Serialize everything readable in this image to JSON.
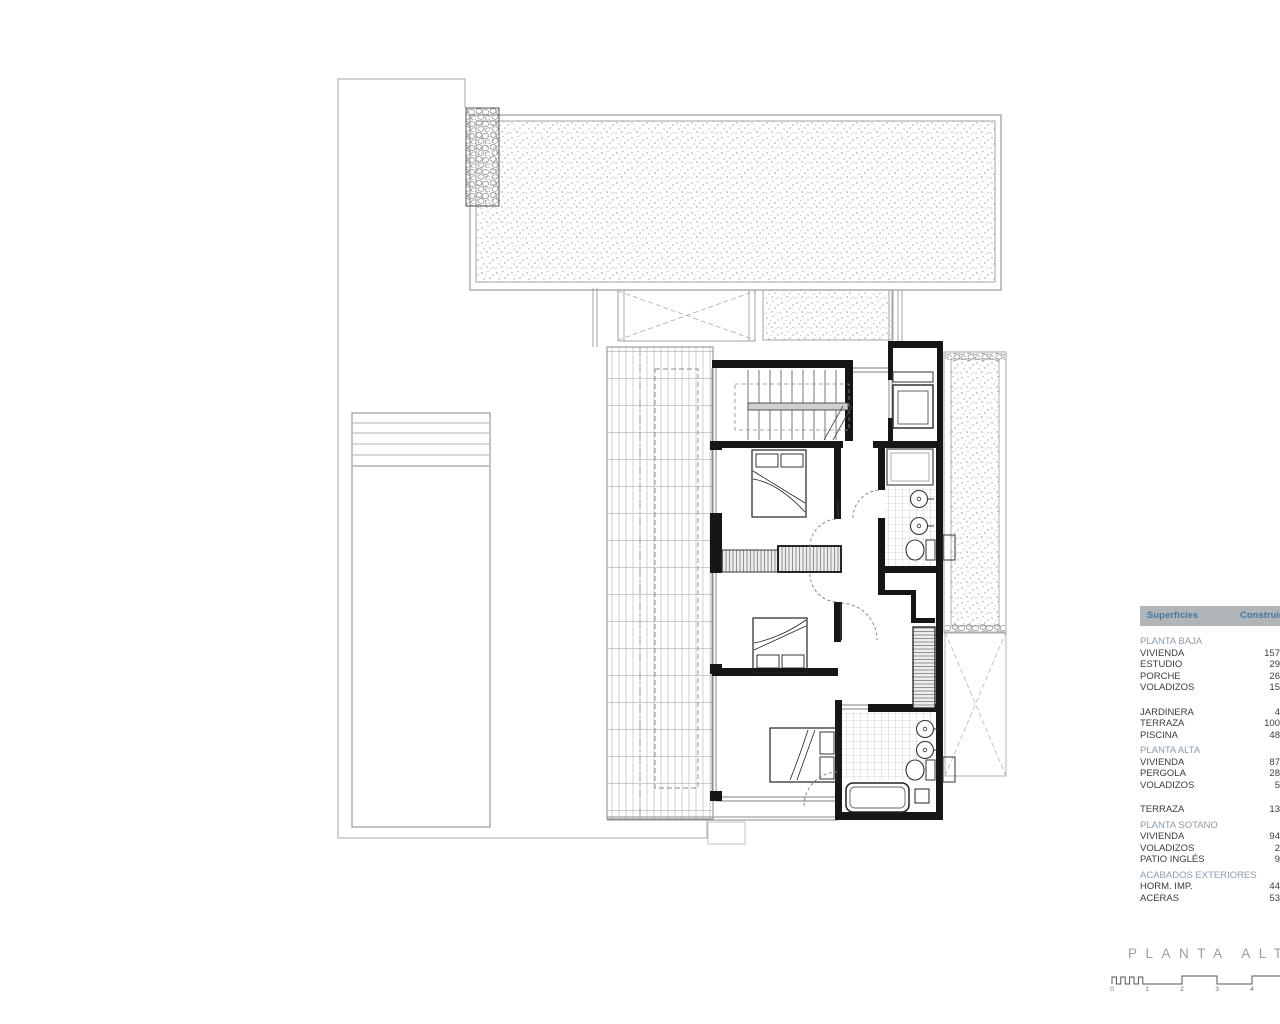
{
  "title_block": {
    "title": "PLANTA ALTA"
  },
  "surfaces_table": {
    "header": {
      "col_label": "Superficies",
      "col_value": "Construida"
    },
    "rows": [
      {
        "type": "section",
        "label": "PLANTA BAJA",
        "value": ""
      },
      {
        "type": "item",
        "label": "VIVIENDA",
        "value": "157"
      },
      {
        "type": "item",
        "label": "ESTUDIO",
        "value": "29"
      },
      {
        "type": "item",
        "label": "PORCHE",
        "value": "26"
      },
      {
        "type": "item",
        "label": "VOLADIZOS",
        "value": "15"
      },
      {
        "type": "spacer",
        "label": "",
        "value": ""
      },
      {
        "type": "item",
        "label": "JARDINERA",
        "value": "4"
      },
      {
        "type": "item",
        "label": "TERRAZA",
        "value": "100"
      },
      {
        "type": "item",
        "label": "PISCINA",
        "value": "48"
      },
      {
        "type": "section",
        "label": "PLANTA ALTA",
        "value": ""
      },
      {
        "type": "item",
        "label": "VIVIENDA",
        "value": "87"
      },
      {
        "type": "item",
        "label": "PERGOLA",
        "value": "28"
      },
      {
        "type": "item",
        "label": "VOLADIZOS",
        "value": "5"
      },
      {
        "type": "spacer",
        "label": "",
        "value": ""
      },
      {
        "type": "item",
        "label": "TERRAZA",
        "value": "13"
      },
      {
        "type": "section",
        "label": "PLANTA SOTANO",
        "value": ""
      },
      {
        "type": "item",
        "label": "VIVIENDA",
        "value": "94"
      },
      {
        "type": "item",
        "label": "VOLADIZOS",
        "value": "2"
      },
      {
        "type": "item",
        "label": "PATIO INGLÉS",
        "value": "9"
      },
      {
        "type": "section",
        "label": "ACABADOS EXTERIORES",
        "value": ""
      },
      {
        "type": "item",
        "label": "HORM. IMP.",
        "value": "44"
      },
      {
        "type": "item",
        "label": "ACERAS",
        "value": "53"
      }
    ]
  },
  "scale_bar": {
    "ticks": [
      "0",
      "1",
      "2",
      "3",
      "4"
    ]
  },
  "colors": {
    "header_bg": "#b2b5b8",
    "header_text": "#44779f",
    "section_text": "#8b9cab",
    "item_text": "#3b3b3b",
    "title_text": "#9c9c9c",
    "scale_text": "#6e6e6e"
  }
}
